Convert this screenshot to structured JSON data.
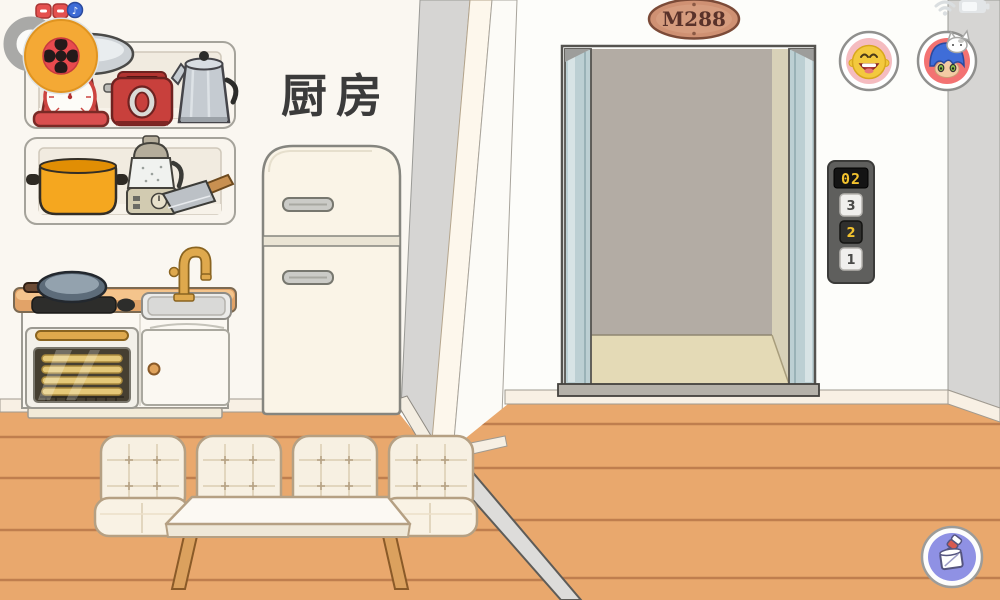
{
  "room": {
    "label": "厨房"
  },
  "elevator": {
    "sign": "M288",
    "display": "02",
    "floor_buttons": [
      "3",
      "2",
      "1"
    ],
    "active_floor": "2"
  },
  "hud": {
    "music_glyph": "♪",
    "avatars": [
      {
        "name": "yellow-baby-face"
      },
      {
        "name": "blue-haired-girl-with-cat"
      }
    ],
    "icons": [
      "camera-lens-button",
      "red-toggle",
      "red-toggle",
      "music-toggle",
      "wifi",
      "battery",
      "paint-decorate-button"
    ]
  },
  "objects": {
    "upper_shelf": [
      "kitchen-scale",
      "toaster",
      "percolator-kettle"
    ],
    "lower_shelf": [
      "orange-pot",
      "blender",
      "cleaver-knife"
    ],
    "counter": [
      "frying-pan",
      "cooktop",
      "stove-knob",
      "sink",
      "faucet",
      "oven",
      "cabinet"
    ],
    "furniture": [
      "refrigerator",
      "floor-cushion",
      "floor-cushion",
      "floor-cushion",
      "floor-cushion",
      "coffee-table"
    ]
  },
  "colors": {
    "floor": "#e9a86d",
    "floor_line": "#bf7e4e",
    "wall": "#fbfaf5",
    "wall_side": "#d6d5d3",
    "elevator_door": "#bccfd3",
    "elevator_back_wall": "#b3aca4",
    "elevator_floor": "#e4dab6",
    "panel_body": "#5f5f5d",
    "display_text": "#f2c22e",
    "plaque": "#cf9173",
    "accent_red": "#d94f4f",
    "accent_orange": "#f5a71f",
    "cushion_cream": "#f7f0e2",
    "wood": "#dba15e",
    "paint_button_bg": "#8f91e4",
    "avatar1_bg": "#f5bcc0",
    "avatar2_bg": "#f37272"
  }
}
